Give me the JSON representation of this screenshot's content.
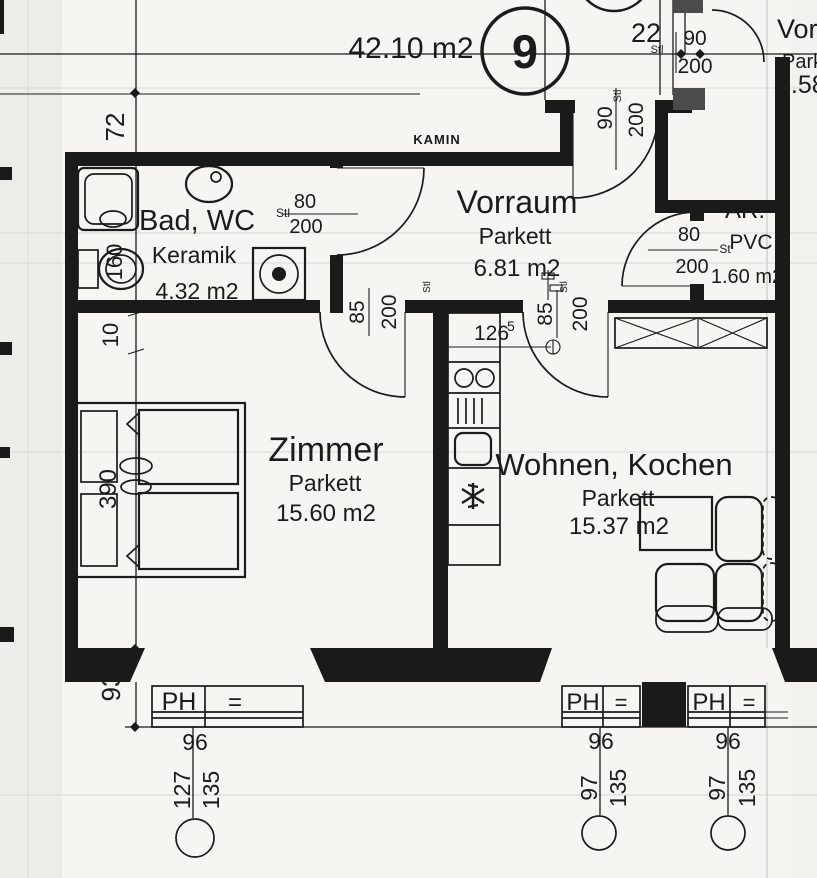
{
  "unit": {
    "number": "9",
    "total_area": "42.10 m2"
  },
  "rooms": {
    "bad": {
      "name": "Bad, WC",
      "floor": "Keramik",
      "area": "4.32 m2"
    },
    "vorraum": {
      "name": "Vorraum",
      "floor": "Parkett",
      "area": "6.81 m2"
    },
    "ar": {
      "name": "AR.",
      "floor": "PVC",
      "area": "1.60 m2"
    },
    "zimmer": {
      "name": "Zimmer",
      "floor": "Parkett",
      "area": "15.60 m2"
    },
    "wohnen": {
      "name": "Wohnen, Kochen",
      "floor": "Parkett",
      "area": "15.37 m2"
    },
    "neighbor": {
      "name": "Vorra",
      "floor": "Parke",
      "area": "7.58"
    }
  },
  "labels": {
    "kamin": "KAMIN",
    "ph": "PH",
    "eq": "=",
    "stl": "Stl",
    "st": "St"
  },
  "doors": {
    "bad": {
      "width": "80",
      "height": "200"
    },
    "entrance": {
      "width": "90",
      "height": "200"
    },
    "zimmer": {
      "width": "85",
      "height": "200"
    },
    "wohnen": {
      "width": "85",
      "height": "200"
    },
    "ar": {
      "width": "80",
      "height": "200"
    },
    "neighbor": {
      "width": "90",
      "height": "200"
    }
  },
  "dims": {
    "d72": "72",
    "d160": "160",
    "d10": "10",
    "d390": "390",
    "d93": "93",
    "d22": "22",
    "d126": "126",
    "d126sup": "5",
    "w1": {
      "width": "96",
      "a": "127",
      "b": "135"
    },
    "w2": {
      "width": "96",
      "a": "97",
      "b": "135"
    },
    "w3": {
      "width": "96",
      "a": "97",
      "b": "135"
    }
  }
}
